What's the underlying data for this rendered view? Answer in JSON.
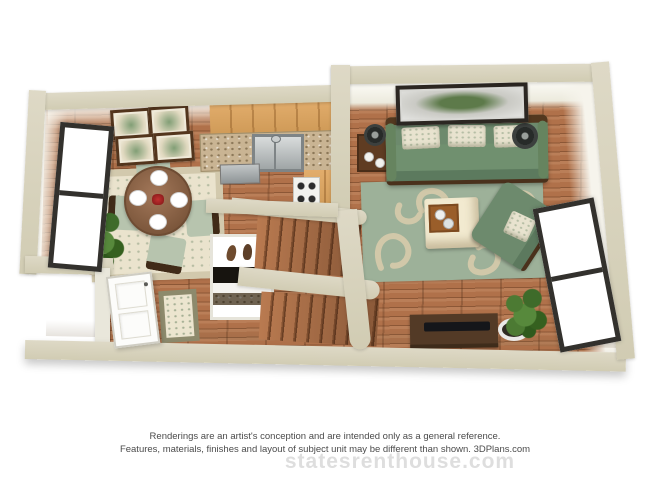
{
  "disclaimer": {
    "line1": "Renderings are an artist's conception and are intended only as a general reference.",
    "line2": "Features, materials, finishes and layout of subject unit may be different than shown. 3DPlans.com"
  },
  "watermark": {
    "text": "statesrenthouse.com"
  },
  "palette": {
    "exterior_wall": "#d8d3bd",
    "interior_wall_face": "#f6f4ec",
    "wood_floor": "#b0714a",
    "wood_floor_line": "#8a5836",
    "kitchen_cabinet": "#dca566",
    "granite_counter": "#c9b493",
    "sofa_green": "#6d8a6d",
    "area_rug_green": "#9db199",
    "rug_pattern_cream": "#d8cbab",
    "dining_rug_cream": "#eae3cd",
    "dining_table_wood": "#8a6347",
    "centerpiece_red": "#a72a2a",
    "picture_frame_dark": "#2c2722",
    "disclaimer_text": "#4b4b4b",
    "watermark_gray": "#dedede"
  }
}
